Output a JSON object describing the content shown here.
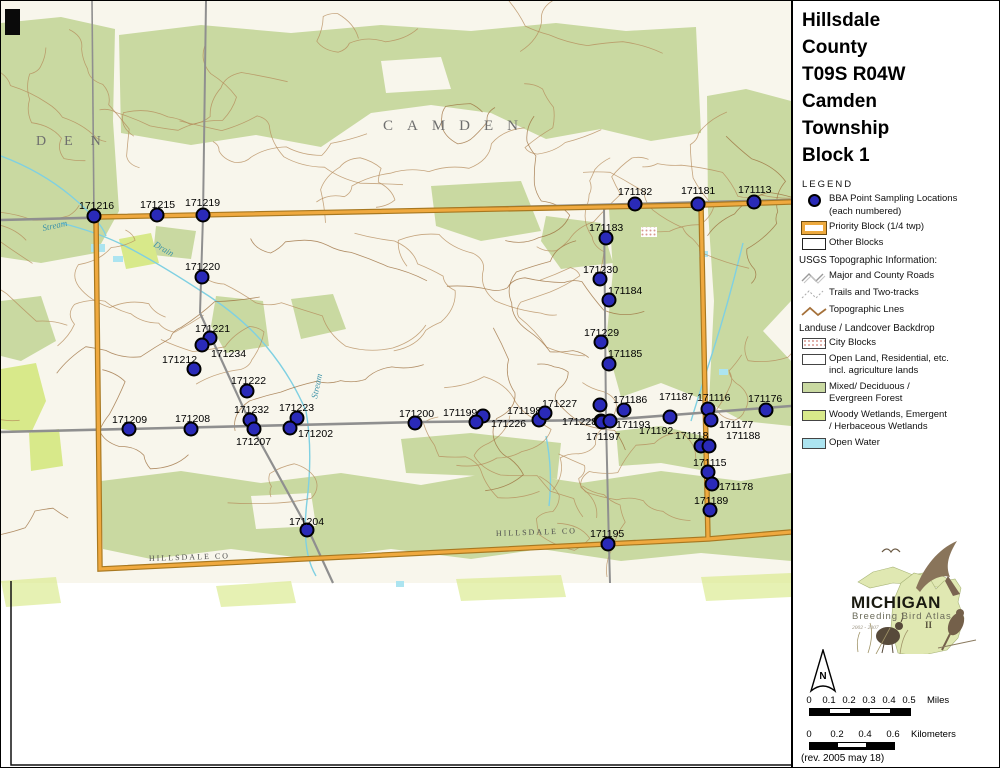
{
  "panel": {
    "title_lines": [
      "Hillsdale",
      "County",
      "T09S R04W",
      "Camden",
      "Township",
      "Block 1"
    ],
    "legend_heading": "LEGEND",
    "legend": {
      "bba_points_line1": "BBA Point Sampling Locations",
      "bba_points_line2": "(each numbered)",
      "priority_block": "Priority Block (1/4 twp)",
      "other_blocks": "Other Blocks",
      "usgs_heading": "USGS Topographic Information:",
      "major_roads": "Major and County Roads",
      "trails": "Trails and Two-tracks",
      "topo_lines": "Topographic Lnes",
      "landuse_heading": "Landuse / Landcover Backdrop",
      "city_blocks": "City Blocks",
      "open_land_line1": "Open Land, Residential, etc.",
      "open_land_line2": "incl. agriculture lands",
      "forest_line1": "Mixed/ Deciduous /",
      "forest_line2": "Evergreen Forest",
      "wetland_line1": "Woody Wetlands, Emergent",
      "wetland_line2": "/ Herbaceous Wetlands",
      "open_water": "Open Water"
    },
    "logo": {
      "state_name": "MICHIGAN",
      "subtitle": "Breeding Bird Atlas",
      "years": "2002 - 2007",
      "numeral": "II"
    },
    "north_label": "N",
    "scale_miles": {
      "ticks": [
        "0",
        "0.1",
        "0.2",
        "0.3",
        "0.4",
        "0.5"
      ],
      "unit": "Miles"
    },
    "scale_km": {
      "ticks": [
        "0",
        "0.2",
        "0.4",
        "0.6"
      ],
      "unit": "Kilometers"
    },
    "revision": "(rev. 2005 may 18)"
  },
  "map": {
    "township_label": "CAMDEN",
    "adjacent_township_label": "DEN",
    "county_line_label": "HILLSDALE CO",
    "county_line_label2": "HILLSDALE CO",
    "stream_label_1": "Stream",
    "stream_label_2": "Drain",
    "stream_label_3": "Stream",
    "colors": {
      "priority_border_orange": "#efa93f",
      "point_blue": "#2a2ab8",
      "forest_green": "#c9d9a1",
      "wetland_green": "#d8e98a",
      "open_water_cyan": "#ace4f0",
      "contour_brown": "#b4895a",
      "road_gray": "#8f8f8f"
    },
    "points": [
      {
        "label": "171216",
        "x": 93,
        "y": 215,
        "lx": 78,
        "ly": 208
      },
      {
        "label": "171215",
        "x": 156,
        "y": 214,
        "lx": 139,
        "ly": 207
      },
      {
        "label": "171219",
        "x": 202,
        "y": 214,
        "lx": 184,
        "ly": 205
      },
      {
        "label": "171220",
        "x": 201,
        "y": 276,
        "lx": 184,
        "ly": 269
      },
      {
        "label": "171221",
        "x": 209,
        "y": 337,
        "lx": 194,
        "ly": 331
      },
      {
        "label": "171234",
        "x": 201,
        "y": 344,
        "lx": 210,
        "ly": 356
      },
      {
        "label": "171212",
        "x": 193,
        "y": 368,
        "lx": 161,
        "ly": 362
      },
      {
        "label": "171222",
        "x": 246,
        "y": 390,
        "lx": 230,
        "ly": 383
      },
      {
        "label": "171232",
        "x": 249,
        "y": 419,
        "lx": 233,
        "ly": 412
      },
      {
        "label": "171207",
        "x": 253,
        "y": 428,
        "lx": 235,
        "ly": 444
      },
      {
        "label": "171223",
        "x": 296,
        "y": 417,
        "lx": 278,
        "ly": 410
      },
      {
        "label": "171202",
        "x": 289,
        "y": 427,
        "lx": 297,
        "ly": 436
      },
      {
        "label": "171209",
        "x": 128,
        "y": 428,
        "lx": 111,
        "ly": 422
      },
      {
        "label": "171208",
        "x": 190,
        "y": 428,
        "lx": 174,
        "ly": 421
      },
      {
        "label": "171200",
        "x": 414,
        "y": 422,
        "lx": 398,
        "ly": 416
      },
      {
        "label": "171199",
        "x": 482,
        "y": 415,
        "lx": 442,
        "ly": 415
      },
      {
        "label": "171226",
        "x": 475,
        "y": 421,
        "lx": 490,
        "ly": 426
      },
      {
        "label": "171198",
        "x": 538,
        "y": 419,
        "lx": 506,
        "ly": 413
      },
      {
        "label": "171227",
        "x": 544,
        "y": 412,
        "lx": 541,
        "ly": 406
      },
      {
        "label": "171228",
        "x": 600,
        "y": 420,
        "lx": 561,
        "ly": 424
      },
      {
        "label": "171197",
        "x": 601,
        "y": 421,
        "lx": 585,
        "ly": 439
      },
      {
        "label": "171193",
        "x": 609,
        "y": 420,
        "lx": 615,
        "ly": 427
      },
      {
        "label": "171186",
        "x": 599,
        "y": 404,
        "lx": 612,
        "ly": 402
      },
      {
        "label": "171192",
        "x": 623,
        "y": 409,
        "lx": 638,
        "ly": 433
      },
      {
        "label": "171187",
        "x": 669,
        "y": 416,
        "lx": 658,
        "ly": 399
      },
      {
        "label": "171116",
        "x": 707,
        "y": 408,
        "lx": 696,
        "ly": 400
      },
      {
        "label": "171176",
        "x": 765,
        "y": 409,
        "lx": 747,
        "ly": 401
      },
      {
        "label": "171177",
        "x": 710,
        "y": 419,
        "lx": 718,
        "ly": 427
      },
      {
        "label": "171118",
        "x": 700,
        "y": 445,
        "lx": 674,
        "ly": 438
      },
      {
        "label": "171188",
        "x": 708,
        "y": 445,
        "lx": 725,
        "ly": 438
      },
      {
        "label": "171115",
        "x": 707,
        "y": 471,
        "lx": 692,
        "ly": 465
      },
      {
        "label": "171178",
        "x": 711,
        "y": 483,
        "lx": 718,
        "ly": 489
      },
      {
        "label": "171189",
        "x": 709,
        "y": 509,
        "lx": 693,
        "ly": 503
      },
      {
        "label": "171195",
        "x": 607,
        "y": 543,
        "lx": 589,
        "ly": 536
      },
      {
        "label": "171204",
        "x": 306,
        "y": 529,
        "lx": 288,
        "ly": 524
      },
      {
        "label": "171183",
        "x": 605,
        "y": 237,
        "lx": 588,
        "ly": 230
      },
      {
        "label": "171230",
        "x": 599,
        "y": 278,
        "lx": 582,
        "ly": 272
      },
      {
        "label": "171184",
        "x": 608,
        "y": 299,
        "lx": 607,
        "ly": 293
      },
      {
        "label": "171229",
        "x": 600,
        "y": 341,
        "lx": 583,
        "ly": 335
      },
      {
        "label": "171185",
        "x": 608,
        "y": 363,
        "lx": 607,
        "ly": 356
      },
      {
        "label": "171182",
        "x": 634,
        "y": 203,
        "lx": 617,
        "ly": 194
      },
      {
        "label": "171181",
        "x": 697,
        "y": 203,
        "lx": 680,
        "ly": 193
      },
      {
        "label": "171113",
        "x": 753,
        "y": 201,
        "lx": 737,
        "ly": 192
      }
    ]
  }
}
